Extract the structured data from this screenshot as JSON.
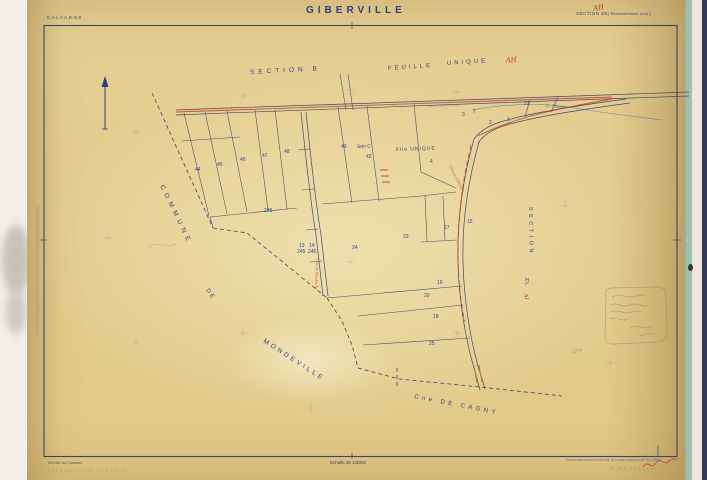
{
  "header": {
    "department": "CALVADOS",
    "title": "GIBERVILLE",
    "section": "SECTION ZK",
    "section_overwrite": "AH",
    "section_note": "( Remembrement rural )"
  },
  "map": {
    "labels": {
      "section_b": "SECTION B",
      "feuille": "FEUILLE",
      "unique": "UNIQUE",
      "ah_red": "AH",
      "son_c": "Son C",
      "flle_unique": "Flle UNIQUE",
      "c_vimont": "C. Vimont",
      "commune": "COMMUNE",
      "de": "DE",
      "mondeville": "MONDEVILLE",
      "cagny": "Cne DE CAGNY",
      "section_vertical": "SECTION",
      "zl": "ZL",
      "ai_red": "AI",
      "road_top": "Ancien Chin de Caen",
      "road_diag": "Chin de Giberville",
      "road_ns": "Chin de Mondeville",
      "pencil_ref": "13 H"
    },
    "parcel_numbers": [
      {
        "v": "44",
        "x": 195,
        "y": 171
      },
      {
        "v": "45",
        "x": 217,
        "y": 166
      },
      {
        "v": "46",
        "x": 240,
        "y": 161
      },
      {
        "v": "47",
        "x": 262,
        "y": 157
      },
      {
        "v": "48",
        "x": 284,
        "y": 153
      },
      {
        "v": "49",
        "x": 341,
        "y": 148
      },
      {
        "v": "42",
        "x": 366,
        "y": 158
      },
      {
        "v": "4",
        "x": 430,
        "y": 163
      },
      {
        "v": "3",
        "x": 462,
        "y": 116
      },
      {
        "v": "2",
        "x": 489,
        "y": 124
      },
      {
        "v": "7",
        "x": 473,
        "y": 113,
        "c": "#c03325"
      },
      {
        "v": "23",
        "x": 524,
        "y": 105,
        "c": "#3f7d3f"
      },
      {
        "v": "23",
        "x": 403,
        "y": 238
      },
      {
        "v": "24",
        "x": 352,
        "y": 249
      },
      {
        "v": "17",
        "x": 444,
        "y": 229
      },
      {
        "v": "15",
        "x": 467,
        "y": 223
      },
      {
        "v": "20",
        "x": 424,
        "y": 297
      },
      {
        "v": "18",
        "x": 433,
        "y": 318
      },
      {
        "v": "25",
        "x": 429,
        "y": 345
      },
      {
        "v": "19",
        "x": 437,
        "y": 284,
        "c": "#3f7d3f"
      },
      {
        "v": "245",
        "x": 264,
        "y": 212,
        "c": "#c03325"
      },
      {
        "v": "13",
        "x": 299,
        "y": 247
      },
      {
        "v": "245",
        "x": 297,
        "y": 253,
        "c": "#c03325"
      },
      {
        "v": "14",
        "x": 309,
        "y": 247
      },
      {
        "v": "246",
        "x": 308,
        "y": 253,
        "c": "#c03325"
      },
      {
        "v": "1",
        "x": 507,
        "y": 121,
        "c": "#c03325"
      }
    ],
    "grid_crosses": [
      [
        350,
        90
      ],
      [
        457,
        92
      ],
      [
        243,
        96
      ],
      [
        136,
        132
      ],
      [
        108,
        238
      ],
      [
        565,
        206
      ],
      [
        243,
        333
      ],
      [
        350,
        262
      ],
      [
        457,
        333
      ],
      [
        311,
        408
      ],
      [
        610,
        363
      ],
      [
        136,
        342
      ]
    ]
  },
  "footer": {
    "service": "Service du Cadastre",
    "reproduction": "REPRODUCTION INTERDITE",
    "scale": "Echelle de 1/2000",
    "update_note": "Remembrement exécuté et rendu exécutoire en 1968",
    "faded_title": "GIBERVILLE"
  },
  "colors": {
    "paper": "#e5cd90",
    "ink_blue": "#2d3f7e",
    "line_blue": "#3e4a6e",
    "red": "#c0392b",
    "green": "#3f7d3f",
    "pencil": "#8d8270",
    "edge_teal": "#8fb8ac",
    "edge_navy": "#333a55"
  }
}
